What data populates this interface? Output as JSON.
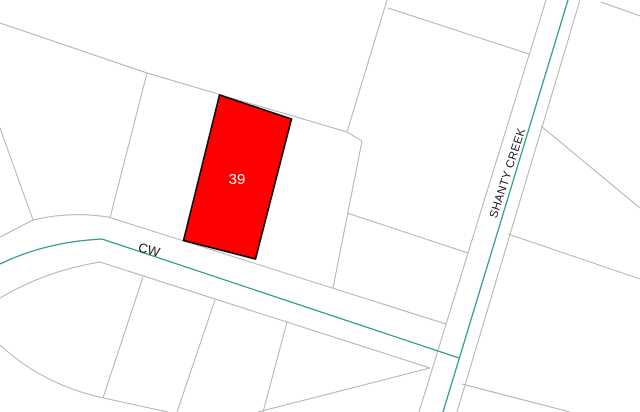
{
  "map": {
    "highlighted_parcel": {
      "number": "39",
      "fill_color": "#ff0000",
      "outline_color": "#000000",
      "label_color": "#ffffff"
    },
    "roads": {
      "cw": {
        "label": "CW"
      },
      "shanty_creek": {
        "label": "SHANTY CREEK"
      }
    },
    "colors": {
      "background": "#ffffff",
      "parcel_lines": "#b3b3b3",
      "road_centerline": "#2e9c91",
      "road_labels": "#1a1a1a"
    }
  }
}
